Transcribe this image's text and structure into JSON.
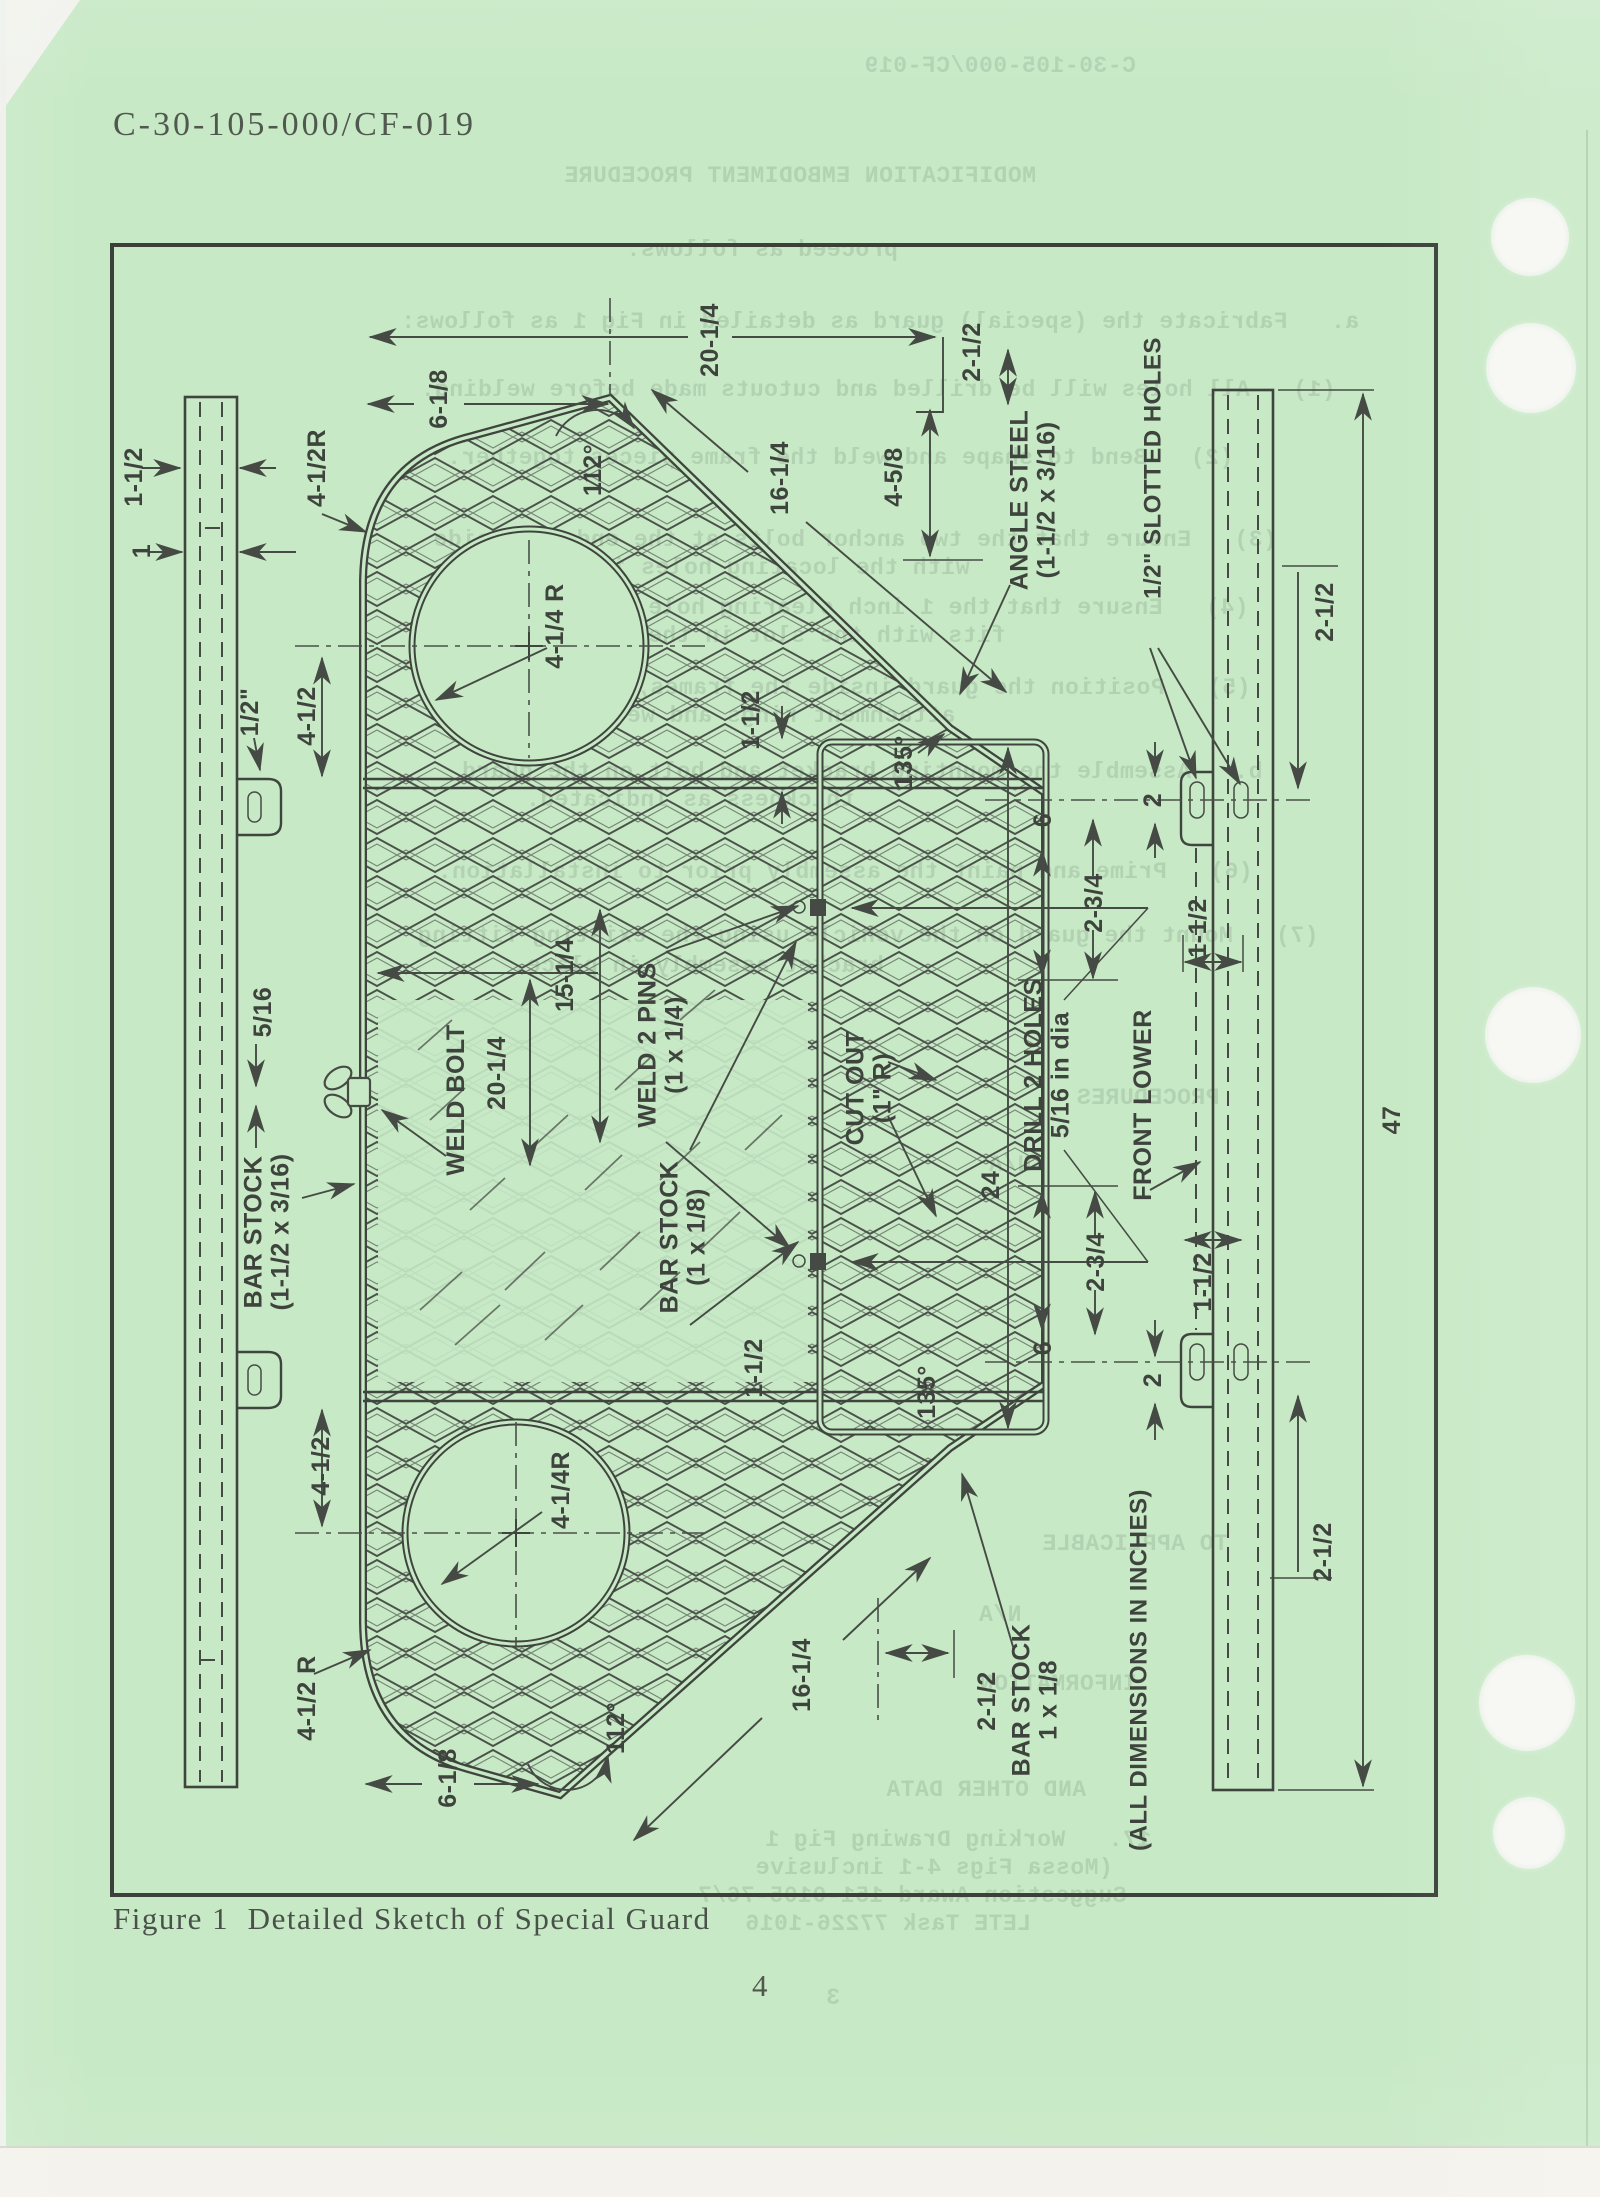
{
  "page": {
    "header_code": "C-30-105-000/CF-019",
    "caption": "Figure 1  Detailed Sketch of Special Guard",
    "page_number": "4"
  },
  "colors": {
    "paper_green": "#c7e9c5",
    "ink": "#454b44",
    "typewriter_ink": "#51584f",
    "bleedthrough": "#9fbda1",
    "punch_hole": "#f6f6f3"
  },
  "diagram": {
    "labels": [
      {
        "t": [
          "1-1/2"
        ],
        "x": 133,
        "y": 477
      },
      {
        "t": [
          "1"
        ],
        "x": 141,
        "y": 551
      },
      {
        "t": [
          "4-1/2R"
        ],
        "x": 316,
        "y": 468
      },
      {
        "t": [
          "1/2\""
        ],
        "x": 249,
        "y": 712
      },
      {
        "t": [
          "4-1/2"
        ],
        "x": 306,
        "y": 716
      },
      {
        "t": [
          "6-1/8"
        ],
        "x": 438,
        "y": 399
      },
      {
        "t": [
          "112°"
        ],
        "x": 592,
        "y": 470
      },
      {
        "t": [
          "20-1/4"
        ],
        "x": 709,
        "y": 340
      },
      {
        "t": [
          "16-1/4"
        ],
        "x": 779,
        "y": 478
      },
      {
        "t": [
          "2-1/2"
        ],
        "x": 971,
        "y": 352
      },
      {
        "t": [
          "4-5/8"
        ],
        "x": 893,
        "y": 477
      },
      {
        "t": [
          "4-1/4 R"
        ],
        "x": 554,
        "y": 626
      },
      {
        "t": [
          "ANGLE STEEL",
          "(1-1/2 x 3/16)"
        ],
        "x": 1032,
        "y": 500
      },
      {
        "t": [
          "1/2\" SLOTTED HOLES"
        ],
        "x": 1152,
        "y": 468,
        "s": 24
      },
      {
        "t": [
          "2-1/2"
        ],
        "x": 1324,
        "y": 612
      },
      {
        "t": [
          "1-1/2"
        ],
        "x": 750,
        "y": 720
      },
      {
        "t": [
          "135°"
        ],
        "x": 903,
        "y": 762
      },
      {
        "t": [
          "2"
        ],
        "x": 1152,
        "y": 800
      },
      {
        "t": [
          "6"
        ],
        "x": 1042,
        "y": 820
      },
      {
        "t": [
          "2-3/4"
        ],
        "x": 1093,
        "y": 903
      },
      {
        "t": [
          "1-1/2"
        ],
        "x": 1197,
        "y": 928
      },
      {
        "t": [
          "5/16"
        ],
        "x": 262,
        "y": 1012
      },
      {
        "t": [
          "WELD BOLT"
        ],
        "x": 455,
        "y": 1100
      },
      {
        "t": [
          "20-1/4"
        ],
        "x": 496,
        "y": 1073
      },
      {
        "t": [
          "15-1/4"
        ],
        "x": 564,
        "y": 975
      },
      {
        "t": [
          "WELD 2 PINS",
          "(1 x 1/4)"
        ],
        "x": 660,
        "y": 1045
      },
      {
        "t": [
          "CUT OUT",
          "(1\" R)"
        ],
        "x": 868,
        "y": 1088
      },
      {
        "t": [
          "DRILL 2 HOLES",
          "5/16 in dia"
        ],
        "x": 1046,
        "y": 1075
      },
      {
        "t": [
          "FRONT LOWER"
        ],
        "x": 1142,
        "y": 1105
      },
      {
        "t": [
          "24"
        ],
        "x": 990,
        "y": 1185
      },
      {
        "t": [
          "47"
        ],
        "x": 1391,
        "y": 1120
      },
      {
        "t": [
          "BAR STOCK",
          "(1-1/2 x 3/16)"
        ],
        "x": 266,
        "y": 1232
      },
      {
        "t": [
          "BAR STOCK",
          "(1 x 1/8)"
        ],
        "x": 682,
        "y": 1237
      },
      {
        "t": [
          "1-1/2"
        ],
        "x": 753,
        "y": 1368
      },
      {
        "t": [
          "135°"
        ],
        "x": 926,
        "y": 1392
      },
      {
        "t": [
          "6"
        ],
        "x": 1042,
        "y": 1348
      },
      {
        "t": [
          "2-3/4"
        ],
        "x": 1095,
        "y": 1262
      },
      {
        "t": [
          "2"
        ],
        "x": 1152,
        "y": 1380
      },
      {
        "t": [
          "1-1/2"
        ],
        "x": 1202,
        "y": 1282
      },
      {
        "t": [
          "2-1/2"
        ],
        "x": 1322,
        "y": 1552
      },
      {
        "t": [
          "4-1/2"
        ],
        "x": 320,
        "y": 1466
      },
      {
        "t": [
          "4-1/4R"
        ],
        "x": 560,
        "y": 1490
      },
      {
        "t": [
          "4-1/2 R"
        ],
        "x": 306,
        "y": 1698
      },
      {
        "t": [
          "112°"
        ],
        "x": 615,
        "y": 1728
      },
      {
        "t": [
          "6-1/8"
        ],
        "x": 447,
        "y": 1778
      },
      {
        "t": [
          "16-1/4"
        ],
        "x": 801,
        "y": 1675
      },
      {
        "t": [
          "2-1/2"
        ],
        "x": 986,
        "y": 1701
      },
      {
        "t": [
          "BAR STOCK",
          "1 x 1/8"
        ],
        "x": 1034,
        "y": 1700
      },
      {
        "t": [
          "(ALL DIMENSIONS IN INCHES)"
        ],
        "x": 1138,
        "y": 1670,
        "s": 24
      }
    ],
    "bleedthrough": [
      {
        "t": "C-30-105-000/CF-019",
        "x": 1000,
        "y": 66
      },
      {
        "t": "MODIFICATION EMBODIMENT PROCEDURE",
        "x": 800,
        "y": 176
      },
      {
        "t": "proceed as follows:",
        "x": 762,
        "y": 250
      },
      {
        "t": "a.   Fabricate the (special) guard as detailed in Fig 1 as follows:",
        "x": 880,
        "y": 322
      },
      {
        "t": "(1)   All holes will be drilled and cutouts made before welding.",
        "x": 878,
        "y": 390
      },
      {
        "t": "(2)   Bend to shape and weld the frame pieces together.",
        "x": 840,
        "y": 458
      },
      {
        "t": "(3)   Ensure that the two anchor bolts at the ends coincide",
        "x": 855,
        "y": 540
      },
      {
        "t": "with the locating holes in the frame.",
        "x": 705,
        "y": 568
      },
      {
        "t": "(4)   Ensure that the 1 inch clearing hole on the centre",
        "x": 848,
        "y": 608
      },
      {
        "t": "fits with the slot in the mounting plate.",
        "x": 712,
        "y": 636
      },
      {
        "t": "(5)   Position the guard inside the frames, complete the",
        "x": 850,
        "y": 688
      },
      {
        "t": "attachment rings and weld in place.",
        "x": 705,
        "y": 716
      },
      {
        "t": "b.   Assemble the mounting bracket and bolt on the guard",
        "x": 862,
        "y": 772
      },
      {
        "t": "thickness as indicated.",
        "x": 690,
        "y": 800
      },
      {
        "t": "(6)   Prime and paint the assembly prior to installation.",
        "x": 845,
        "y": 872
      },
      {
        "t": "(7)   Mount the guard on the vehicle using the existing fitting",
        "x": 868,
        "y": 936
      },
      {
        "t": "bracket assembly in place.",
        "x": 698,
        "y": 966
      },
      {
        "t": "PROCEDURES",
        "x": 1148,
        "y": 1098
      },
      {
        "t": "N/A",
        "x": 1010,
        "y": 1165
      },
      {
        "t": "TO APPLICABLE",
        "x": 1135,
        "y": 1544
      },
      {
        "t": "N/A",
        "x": 1000,
        "y": 1615
      },
      {
        "t": "INFORMATION",
        "x": 1058,
        "y": 1684
      },
      {
        "t": "AND OTHER DATA",
        "x": 986,
        "y": 1790
      },
      {
        "t": "17.   Working Drawing Fig 1",
        "x": 958,
        "y": 1840
      },
      {
        "t": "(Mossa Figs 4-1 inclusive",
        "x": 934,
        "y": 1868
      },
      {
        "t": "Suggestion Award 151-0105-76/7",
        "x": 912,
        "y": 1896
      },
      {
        "t": "LETE Task 77226-1016",
        "x": 888,
        "y": 1924
      },
      {
        "t": "3",
        "x": 833,
        "y": 1998
      }
    ]
  }
}
